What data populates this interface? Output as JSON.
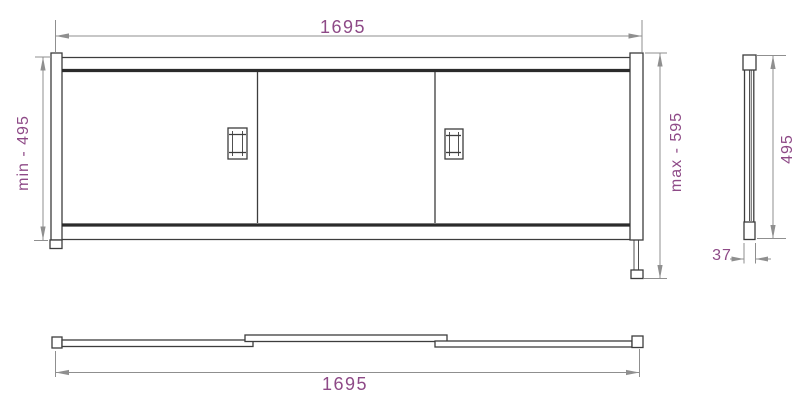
{
  "drawing": {
    "front_view": {
      "top_width": "1695",
      "min_height": "min - 495",
      "max_height": "max - 595"
    },
    "side_view": {
      "height": "495",
      "depth": "37"
    },
    "plan_view": {
      "width": "1695"
    }
  },
  "colors": {
    "background": "#ffffff",
    "outline": "#3d3d3d",
    "outline_dark": "#2b2b2b",
    "dim_line": "#8f8f8f",
    "dim_text": "#8e4a87"
  }
}
